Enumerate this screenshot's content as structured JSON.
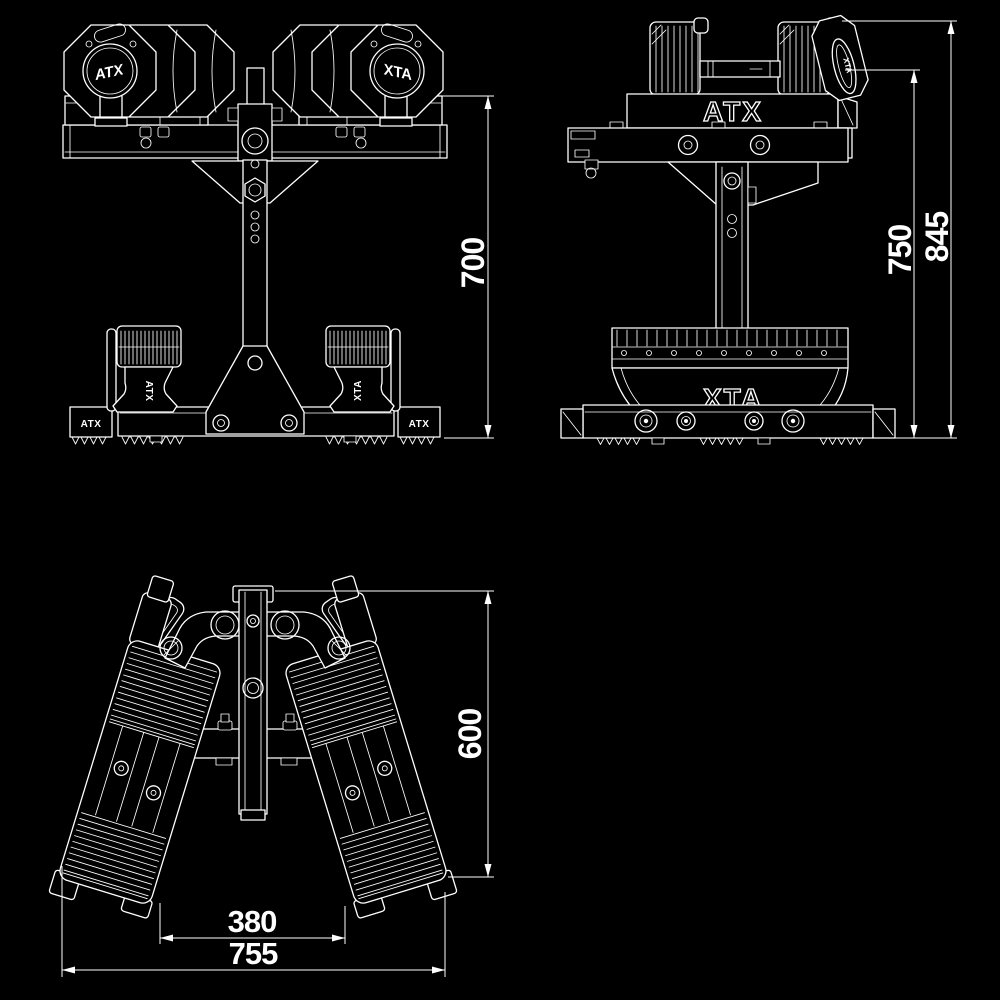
{
  "meta": {
    "drawing_type": "technical dimension drawing, three orthographic views, white line art",
    "background_color": "#000000",
    "line_color": "#ffffff"
  },
  "brand": {
    "name": "ATX"
  },
  "dimensions": {
    "front_height": "700",
    "side_inner_height": "750",
    "side_overall_height": "845",
    "top_depth": "600",
    "top_inner_width": "380",
    "top_overall_width": "755"
  }
}
